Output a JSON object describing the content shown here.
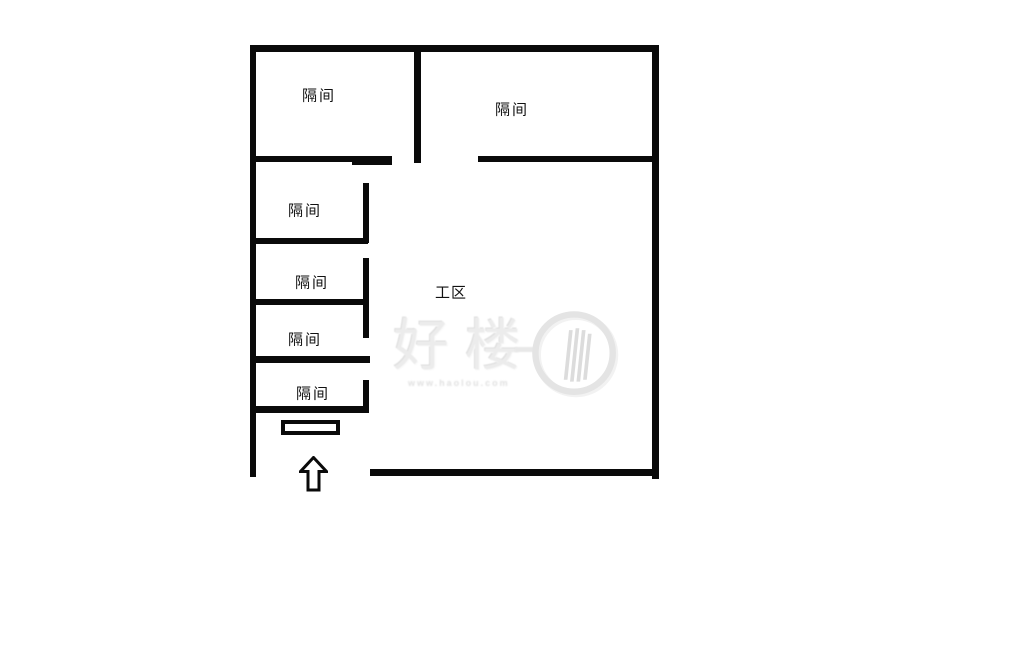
{
  "colors": {
    "wall": "#0a0a0a",
    "background": "#ffffff",
    "watermark_gray": "#ececec"
  },
  "floorplan": {
    "compartments": [
      {
        "label": "隔间"
      },
      {
        "label": "隔间"
      },
      {
        "label": "隔间"
      },
      {
        "label": "隔间"
      },
      {
        "label": "隔间"
      },
      {
        "label": "隔间"
      }
    ],
    "work_area": {
      "label": "工区"
    },
    "watermark": {
      "brand": "好楼",
      "url_text": "www.haolou.com"
    }
  }
}
